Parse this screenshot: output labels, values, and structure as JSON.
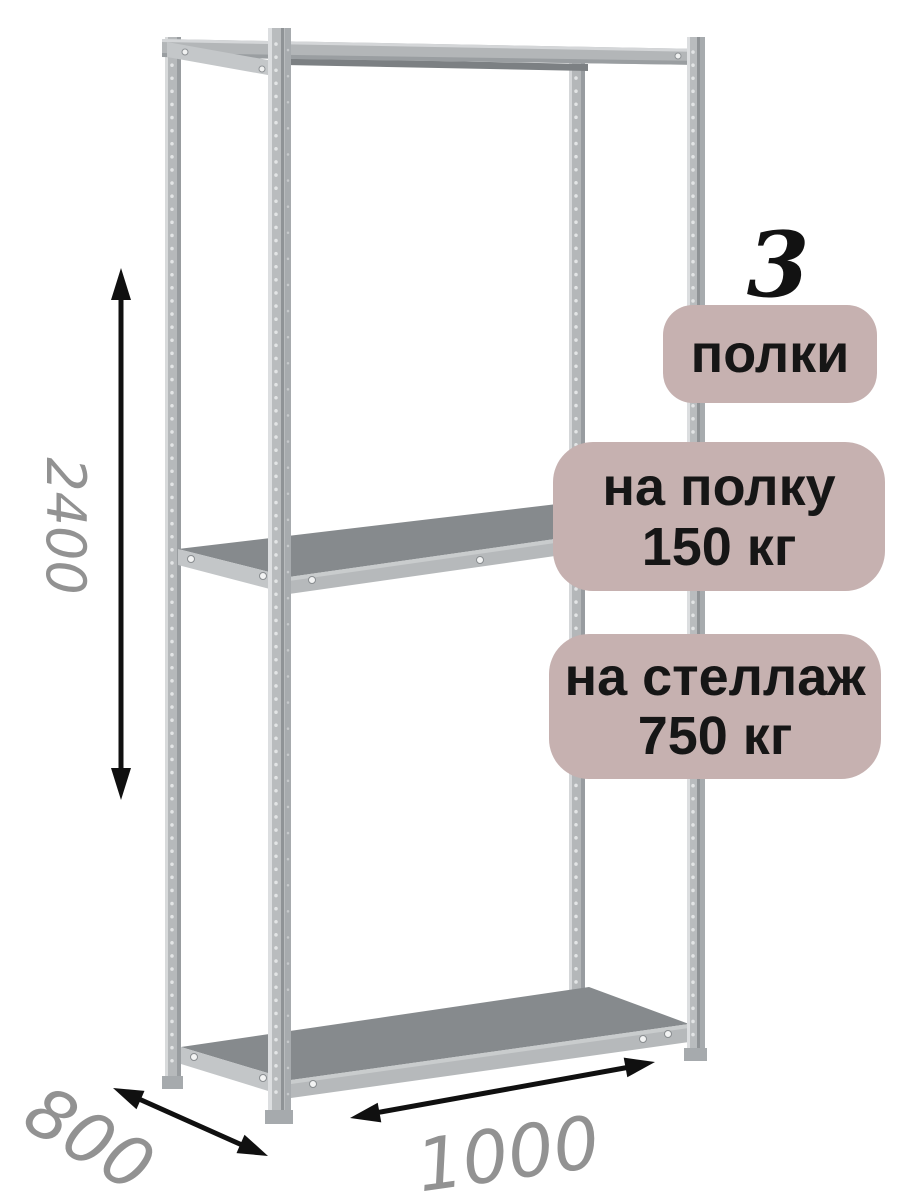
{
  "annotations": {
    "shelf_count_number": "3",
    "shelf_count_label": "полки",
    "per_shelf_load_line1": "на полку",
    "per_shelf_load_line2": "150 кг",
    "per_rack_load_line1": "на стеллаж",
    "per_rack_load_line2": "750 кг"
  },
  "dimensions": {
    "height": "2400",
    "depth": "800",
    "width": "1000"
  },
  "colors": {
    "background": "#ffffff",
    "badge_background": "#c6b1b0",
    "badge_text": "#161616",
    "dimension_text": "#929292",
    "arrow": "#101010",
    "metal_highlight": "#d8dadb",
    "metal_base": "#b7babc",
    "metal_shadow": "#94989b",
    "shelf_top_surface": "#868a8d"
  }
}
